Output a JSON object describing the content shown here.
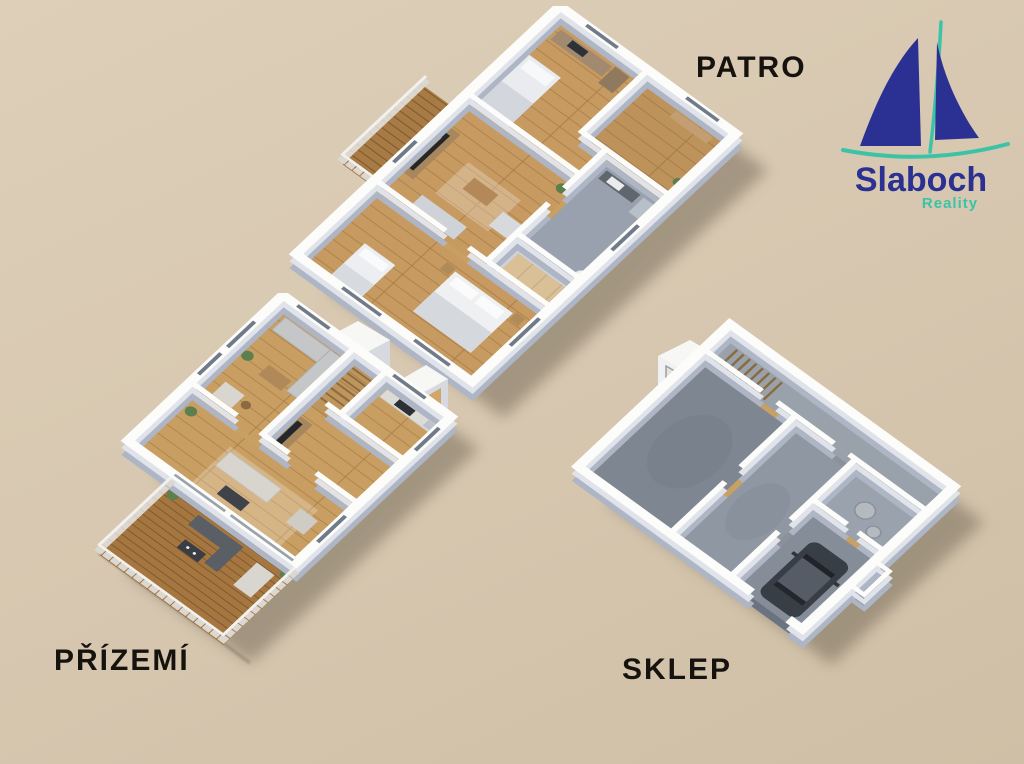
{
  "canvas": {
    "background_color": "#d8c8b1",
    "description_icons": {
      "patro_plan": "upper-floor-3d-floorplan",
      "prizemi_plan": "ground-floor-3d-floorplan",
      "sklep_plan": "basement-3d-floorplan"
    }
  },
  "labels": {
    "upper_floor": "PATRO",
    "ground_floor": "PŘÍZEMÍ",
    "basement": "SKLEP"
  },
  "logo": {
    "title": "Slaboch",
    "subtitle": "Reality",
    "icon": "sailboat-icon",
    "brand_navy": "#2b3192",
    "brand_teal": "#3bc3a6"
  }
}
